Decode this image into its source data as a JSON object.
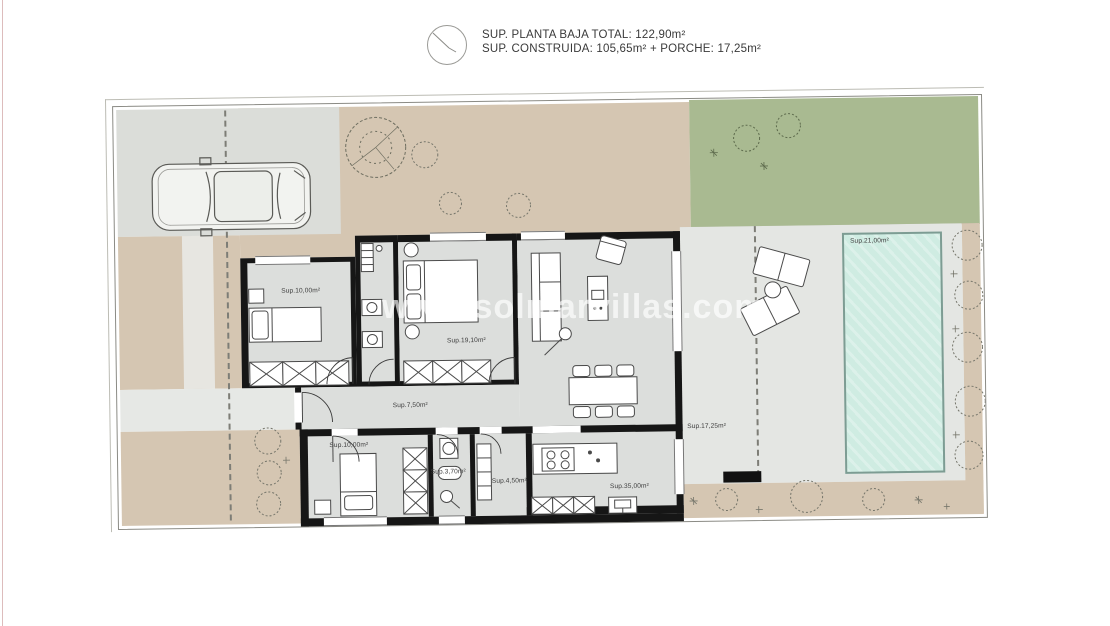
{
  "header": {
    "area_line_1": "SUP. PLANTA BAJA TOTAL: 122,90m²",
    "area_line_2": "SUP. CONSTRUIDA: 105,65m² + PORCHE: 17,25m²",
    "compass_icon": "north-indicator-circle"
  },
  "watermark": "www.solmarvillas.com",
  "floor_plan": {
    "room_labels": {
      "bedroom_top_left": "Sup.10,00m²",
      "bedroom_main": "Sup.19,10m²",
      "hallway": "Sup.7,50m²",
      "bedroom_bottom": "Sup.10,00m²",
      "bathroom_bottom": "Sup.3,70m²",
      "utility": "Sup.4,50m²",
      "living_kitchen": "Sup.35,00m²",
      "porch": "Sup.17,25m²",
      "pool": "Sup.21,00m²"
    },
    "features": [
      "car",
      "driveway",
      "gravel-garden",
      "lawn",
      "pool",
      "sun-loungers",
      "terrace",
      "trees",
      "bushes"
    ],
    "colors": {
      "gravel": "#d5c6b2",
      "lawn": "#a9ba91",
      "driveway": "#dbddd9",
      "terrace": "#e4e6e3",
      "pool_water": "#cfece2",
      "interior_floor": "#dcdedc",
      "walls": "#161616",
      "accent_edge_line": "#ddbcbc"
    }
  }
}
